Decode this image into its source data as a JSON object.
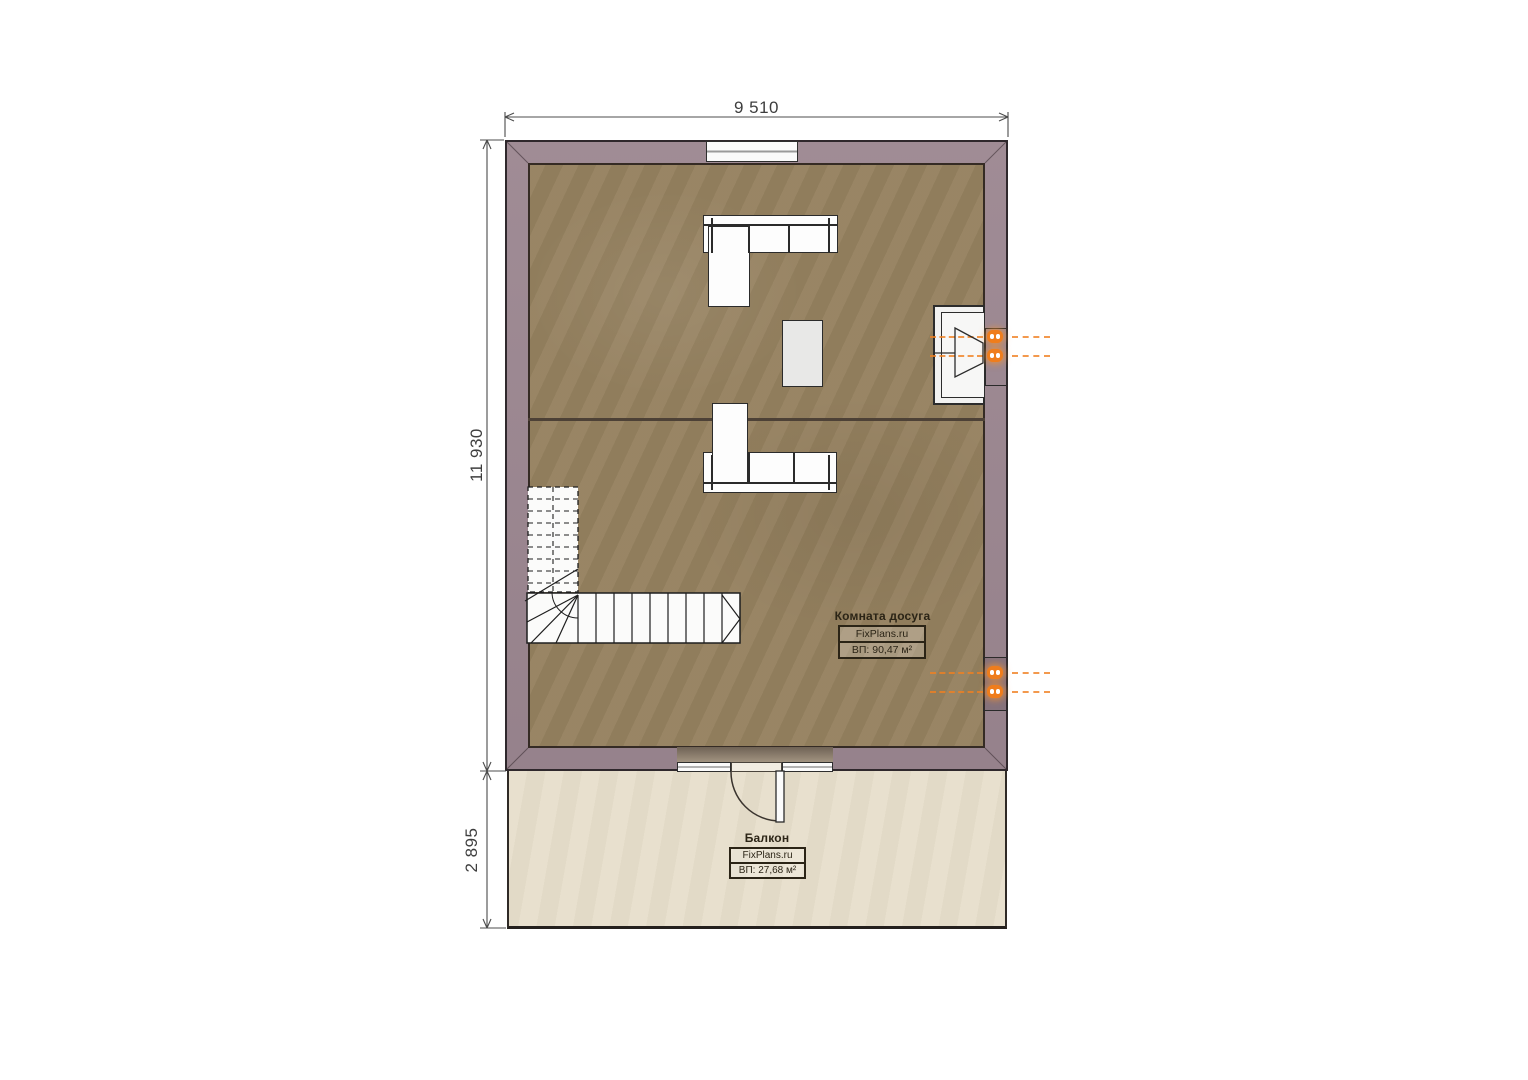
{
  "plan": {
    "dimensions": {
      "top_width": "9 510",
      "left_height": "11 930",
      "balcony_depth": "2 895"
    },
    "rooms": {
      "leisure": {
        "name": "Комната досуга",
        "brand": "FixPlans.ru",
        "area": "ВП: 90,47 м²"
      },
      "balcony": {
        "name": "Балкон",
        "brand": "FixPlans.ru",
        "area": "ВП: 27,68 м²"
      }
    },
    "colors": {
      "wall": "#9c8791",
      "wall_outline": "#2f282c",
      "floor": "#95815f",
      "balcony_floor": "#e7decb",
      "outlet_accent": "#ef7d1c",
      "dimension_text": "#3e3e3e"
    }
  }
}
